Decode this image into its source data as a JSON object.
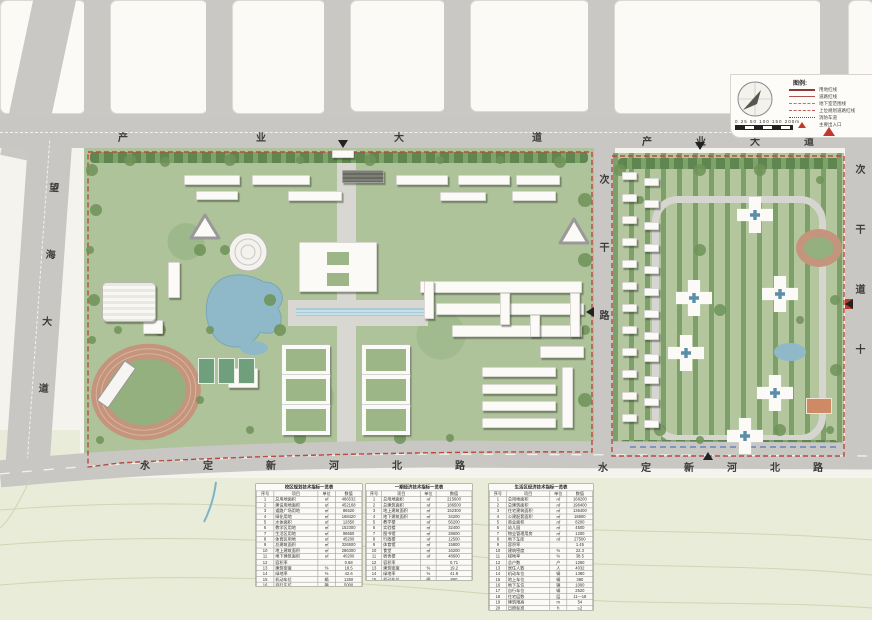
{
  "roads": {
    "top_avenue_left": "产业大道",
    "top_avenue_right": "产业大道",
    "left_avenue": "望海大道",
    "middle_road": "次干路",
    "right_road": "次干道十",
    "bottom_road_left": "水定新河北路",
    "bottom_road_right": "水定新河北路"
  },
  "legend": {
    "title": "图例:",
    "items": [
      {
        "style": "solid-dark-red",
        "label": "用地红线"
      },
      {
        "style": "solid-red",
        "label": "道路红线"
      },
      {
        "style": "dashed-blue",
        "label": "地下室范围线"
      },
      {
        "style": "dashed-red",
        "label": "上位规划道路红线"
      },
      {
        "style": "dotted-black",
        "label": "消防车道"
      },
      {
        "style": "tri-red",
        "label": "主要出入口"
      }
    ],
    "scale_ticks": "0 25 50 100 150 200m"
  },
  "tables": [
    {
      "title": "校区规划技术指标一览表",
      "headers": [
        "序号",
        "项目",
        "单位",
        "数值"
      ],
      "rows": [
        [
          "1",
          "总用地面积",
          "㎡",
          "486532"
        ],
        [
          "2",
          "建设用地面积",
          "㎡",
          "452168"
        ],
        [
          "3",
          "道路广场用地",
          "㎡",
          "86520"
        ],
        [
          "4",
          "绿化用地",
          "㎡",
          "168420"
        ],
        [
          "5",
          "水体面积",
          "㎡",
          "12650"
        ],
        [
          "6",
          "教学区用地",
          "㎡",
          "152300"
        ],
        [
          "7",
          "生活区用地",
          "㎡",
          "98650"
        ],
        [
          "8",
          "体育区用地",
          "㎡",
          "45200"
        ],
        [
          "9",
          "总建筑面积",
          "㎡",
          "326500"
        ],
        [
          "10",
          "地上建筑面积",
          "㎡",
          "286300"
        ],
        [
          "11",
          "地下建筑面积",
          "㎡",
          "40200"
        ],
        [
          "12",
          "容积率",
          "",
          "0.68"
        ],
        [
          "13",
          "建筑密度",
          "%",
          "18.5"
        ],
        [
          "14",
          "绿地率",
          "%",
          "42.6"
        ],
        [
          "15",
          "机动车位",
          "辆",
          "1250"
        ],
        [
          "16",
          "自行车位",
          "辆",
          "5000"
        ],
        [
          "17",
          "学生规模",
          "人",
          "12000"
        ],
        [
          "18",
          "建筑限高",
          "m",
          "50"
        ]
      ]
    },
    {
      "title": "一期经济技术指标一览表",
      "headers": [
        "序号",
        "项目",
        "单位",
        "数值"
      ],
      "rows": [
        [
          "1",
          "总用地面积",
          "㎡",
          "215600"
        ],
        [
          "2",
          "总建筑面积",
          "㎡",
          "186500"
        ],
        [
          "3",
          "地上建筑面积",
          "㎡",
          "152300"
        ],
        [
          "4",
          "地下建筑面积",
          "㎡",
          "34200"
        ],
        [
          "5",
          "教学楼",
          "㎡",
          "56200"
        ],
        [
          "6",
          "实验楼",
          "㎡",
          "32400"
        ],
        [
          "7",
          "图书馆",
          "㎡",
          "28600"
        ],
        [
          "8",
          "行政楼",
          "㎡",
          "12500"
        ],
        [
          "9",
          "体育馆",
          "㎡",
          "15800"
        ],
        [
          "10",
          "食堂",
          "㎡",
          "16200"
        ],
        [
          "11",
          "宿舍楼",
          "㎡",
          "48600"
        ],
        [
          "12",
          "容积率",
          "",
          "0.71"
        ],
        [
          "13",
          "建筑密度",
          "%",
          "19.2"
        ],
        [
          "14",
          "绿地率",
          "%",
          "41.8"
        ],
        [
          "15",
          "机动车位",
          "辆",
          "860"
        ],
        [
          "16",
          "建设周期",
          "年",
          "2016—2018"
        ]
      ]
    },
    {
      "title": "生活区经济技术指标一览表",
      "headers": [
        "序号",
        "项目",
        "单位",
        "数值"
      ],
      "rows": [
        [
          "1",
          "总用地面积",
          "㎡",
          "168200"
        ],
        [
          "2",
          "总建筑面积",
          "㎡",
          "196400"
        ],
        [
          "3",
          "住宅建筑面积",
          "㎡",
          "136400"
        ],
        [
          "4",
          "公建配套面积",
          "㎡",
          "18600"
        ],
        [
          "5",
          "商业面积",
          "㎡",
          "8200"
        ],
        [
          "6",
          "幼儿园",
          "㎡",
          "4500"
        ],
        [
          "7",
          "物业管理用房",
          "㎡",
          "1200"
        ],
        [
          "8",
          "地下车库",
          "㎡",
          "27500"
        ],
        [
          "9",
          "容积率",
          "",
          "1.45"
        ],
        [
          "10",
          "建筑密度",
          "%",
          "22.3"
        ],
        [
          "11",
          "绿地率",
          "%",
          "38.5"
        ],
        [
          "12",
          "总户数",
          "户",
          "1260"
        ],
        [
          "13",
          "居住人数",
          "人",
          "4032"
        ],
        [
          "14",
          "机动车位",
          "辆",
          "1380"
        ],
        [
          "15",
          "地上车位",
          "辆",
          "380"
        ],
        [
          "16",
          "地下车位",
          "辆",
          "1000"
        ],
        [
          "17",
          "自行车位",
          "辆",
          "2520"
        ],
        [
          "18",
          "住宅层数",
          "层",
          "11—18"
        ],
        [
          "19",
          "建筑限高",
          "m",
          "54"
        ],
        [
          "20",
          "日照标准",
          "h",
          "≥2"
        ]
      ]
    }
  ]
}
